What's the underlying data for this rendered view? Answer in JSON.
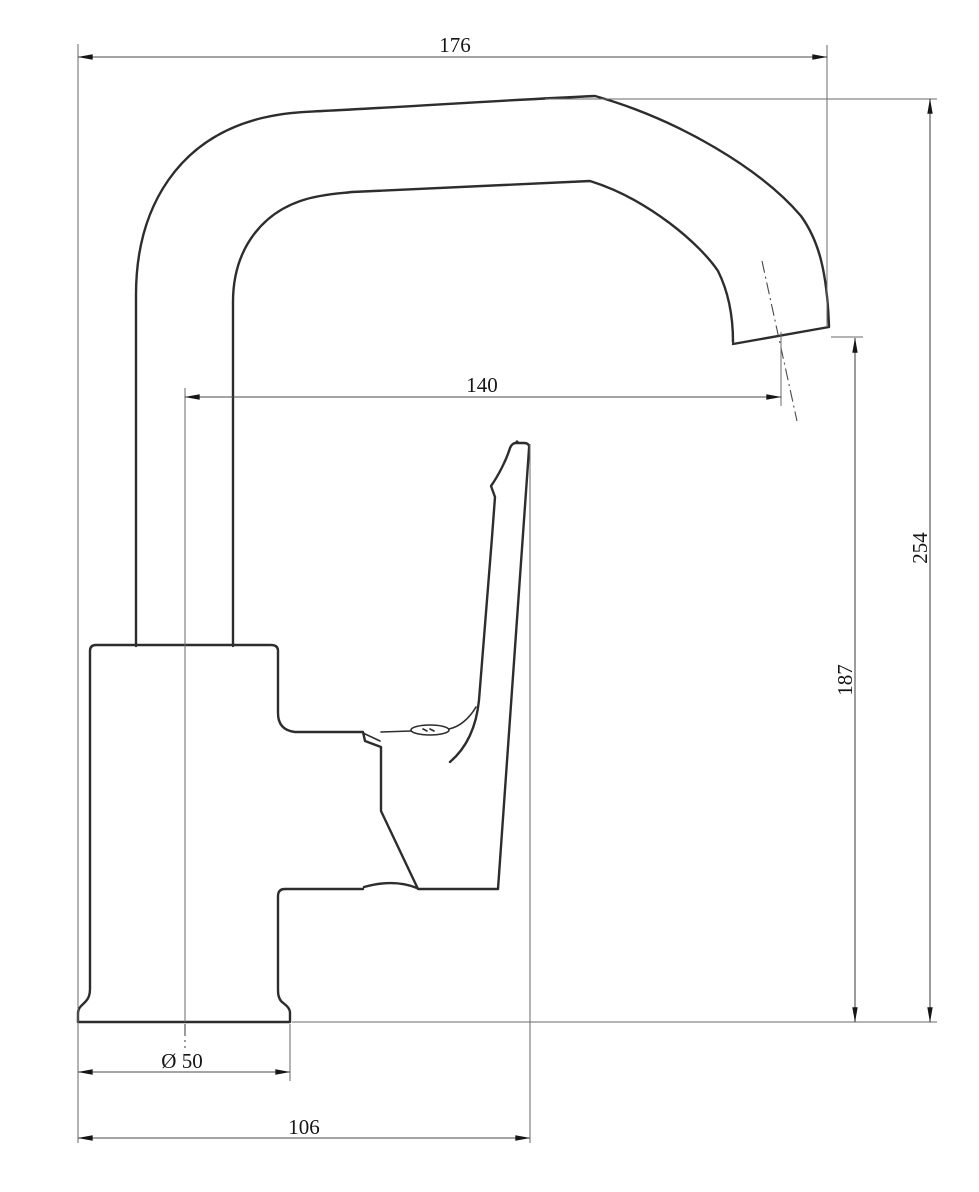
{
  "drawing": {
    "colors": {
      "background": "#ffffff",
      "object_line": "#2d2d2d",
      "dimension_line": "#4a4a4a",
      "extension_line": "#6a6a6a",
      "text": "#161616"
    },
    "dims": {
      "top_width": "176",
      "spout_reach": "140",
      "total_height": "254",
      "outlet_height": "187",
      "base_diameter": "Ø 50",
      "base_span": "106"
    }
  }
}
